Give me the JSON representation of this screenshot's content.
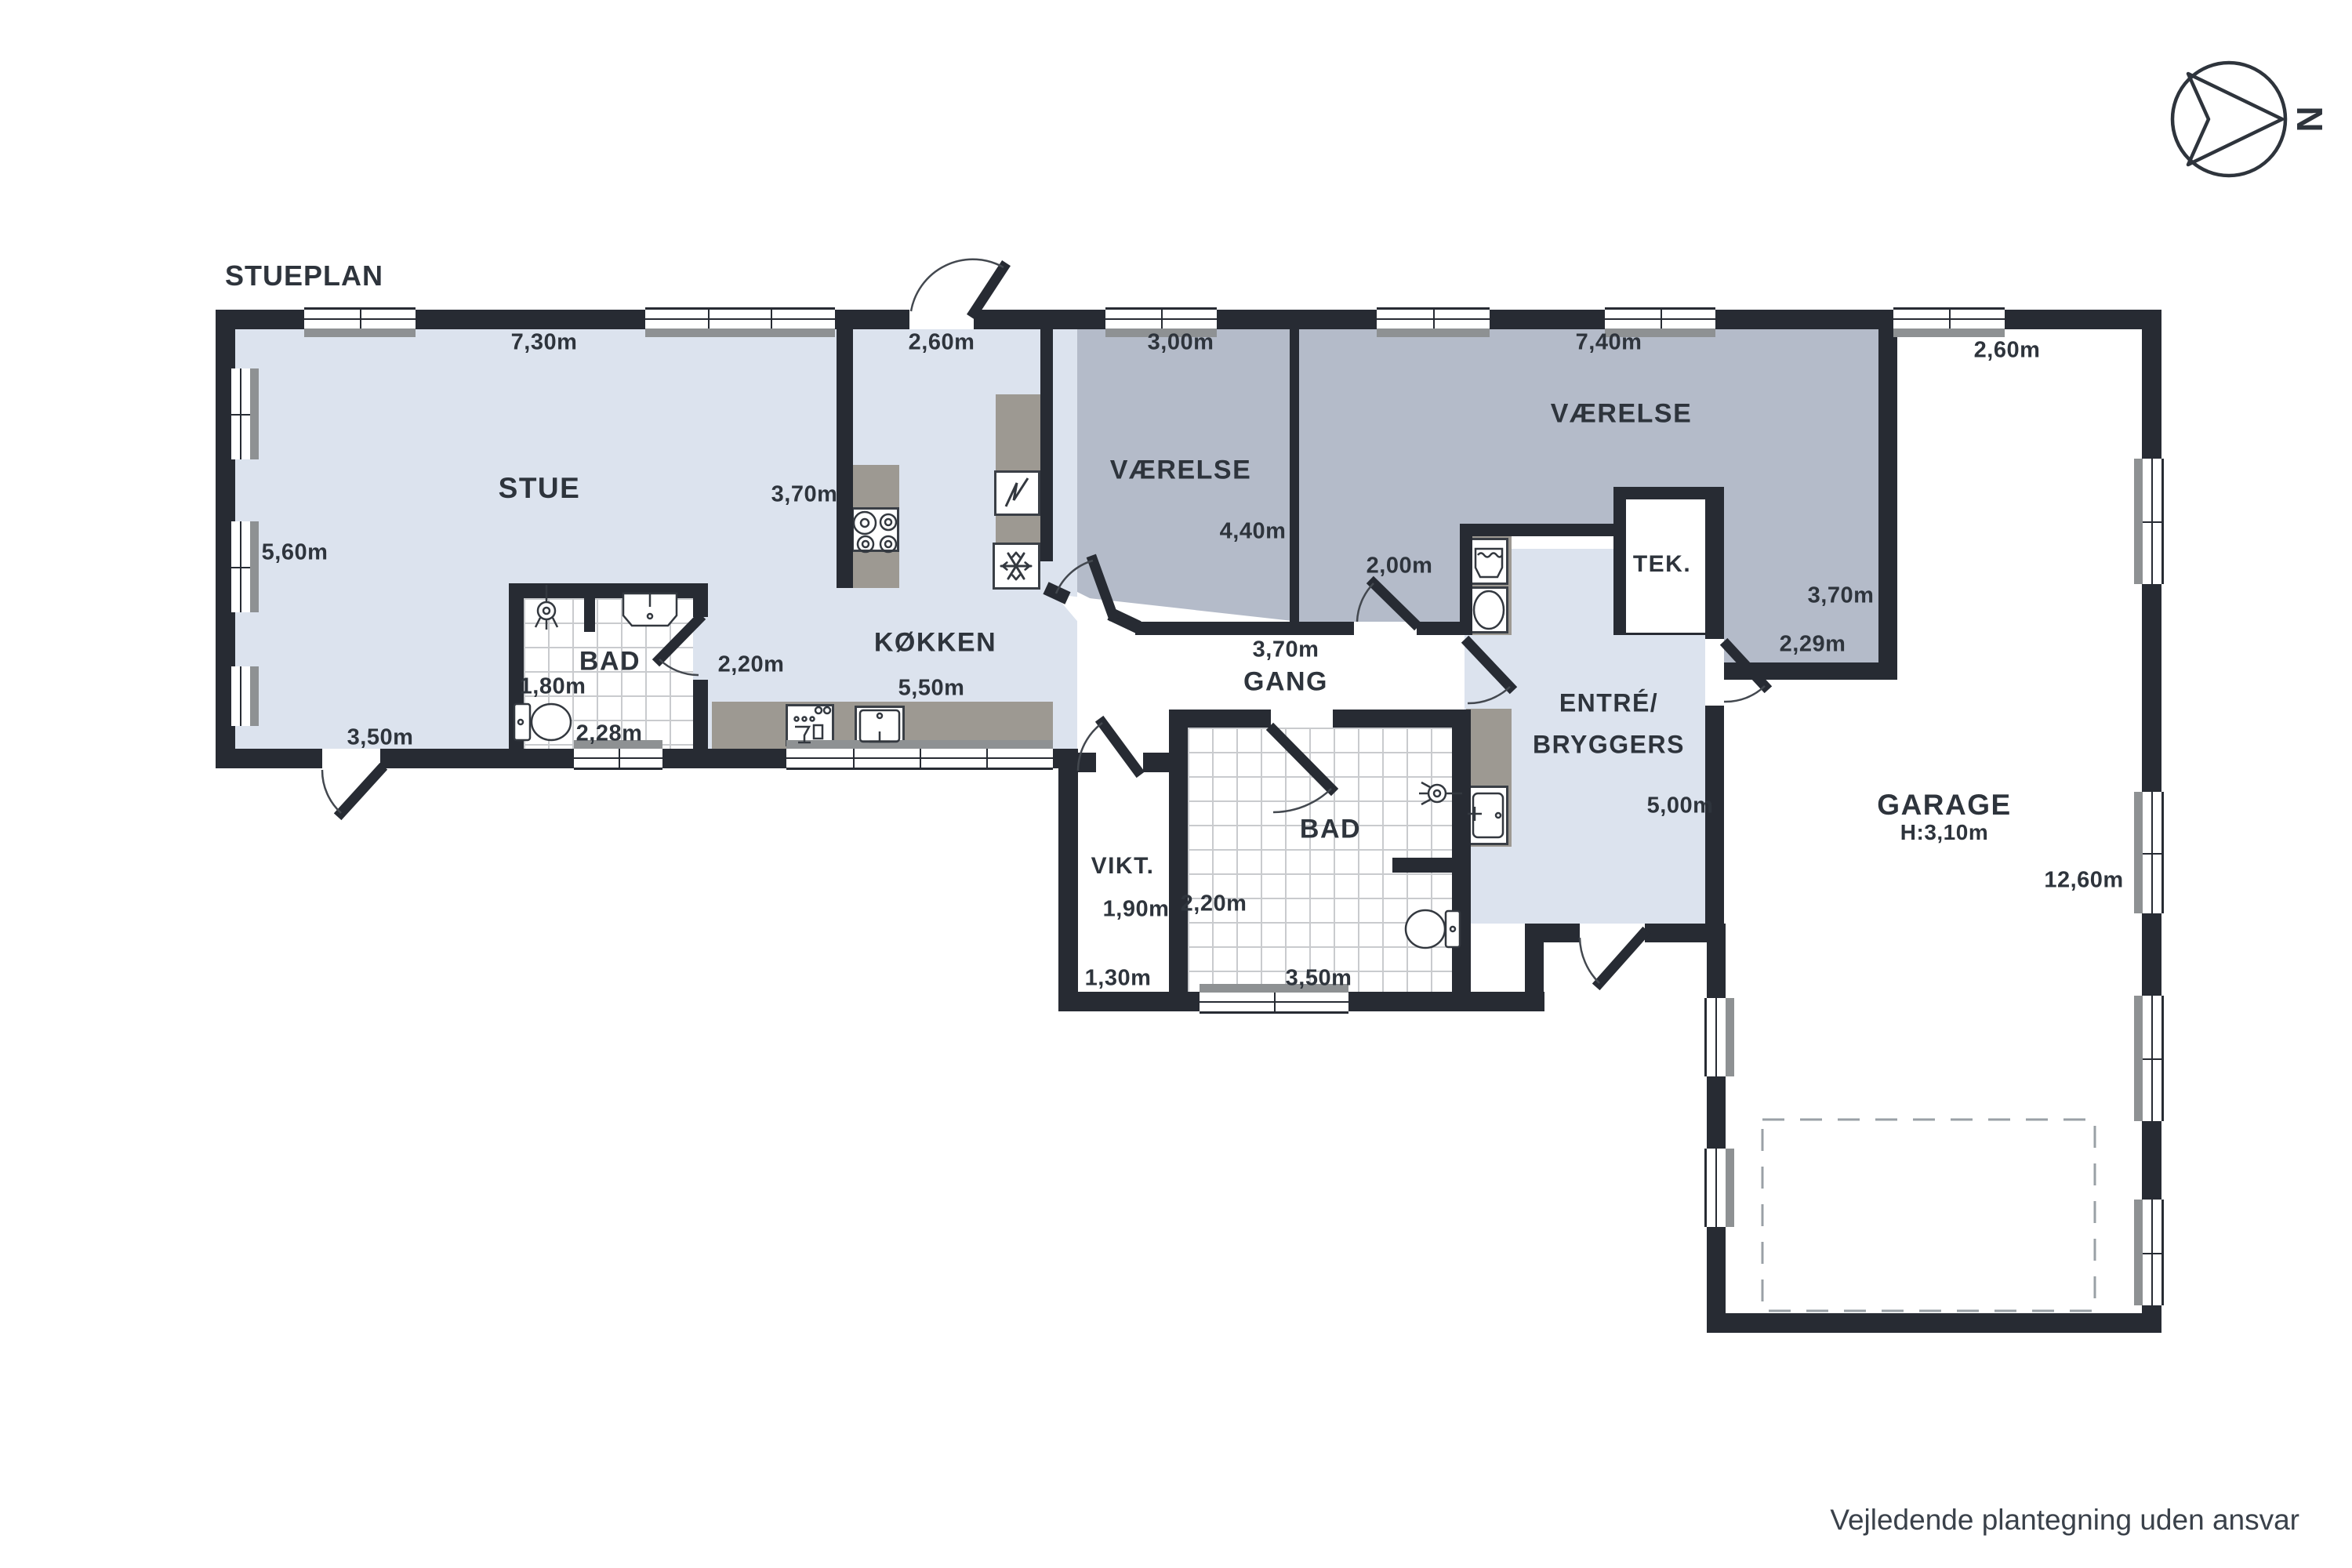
{
  "title": "STUEPLAN",
  "disclaimer": "Vejledende plantegning uden ansvar",
  "compass": {
    "north": "N"
  },
  "rooms": {
    "stue": "STUE",
    "kokken": "KØKKEN",
    "bad1": "BAD",
    "vaerelse1": "VÆRELSE",
    "vaerelse2": "VÆRELSE",
    "gang": "GANG",
    "vikt": "VIKT.",
    "bad2": "BAD",
    "entre_line1": "ENTRÉ/",
    "entre_line2": "BRYGGERS",
    "tek": "TEK.",
    "garage": "GARAGE",
    "garage_height": "H:3,10m"
  },
  "dimensions": {
    "stue_width": "7,30m",
    "stue_depth": "5,60m",
    "stue_door": "3,50m",
    "kokken_nook_width": "2,60m",
    "kokken_depth": "3,70m",
    "kokken_width": "5,50m",
    "bad1_door": "2,20m",
    "bad1_depth": "1,80m",
    "bad1_width": "2,28m",
    "vaerelse1_width": "3,00m",
    "vaerelse1_depth": "4,40m",
    "vaerelse2_width": "7,40m",
    "vaerelse2_depth": "3,70m",
    "vaerelse2_lobe": "2,29m",
    "vaerelse2_door": "2,00m",
    "gang_width": "3,70m",
    "vikt_depth": "1,90m",
    "vikt_width": "1,30m",
    "bad2_depth": "2,20m",
    "bad2_width": "3,50m",
    "entre_depth": "5,00m",
    "garage_top_width": "2,60m",
    "garage_depth": "12,60m"
  },
  "colors": {
    "wall": "#272b33",
    "floor_light": "#dce3ee",
    "floor_grey": "#b4bbc9",
    "counter_grey": "#9d9992",
    "window_sill": "#8e9193"
  }
}
